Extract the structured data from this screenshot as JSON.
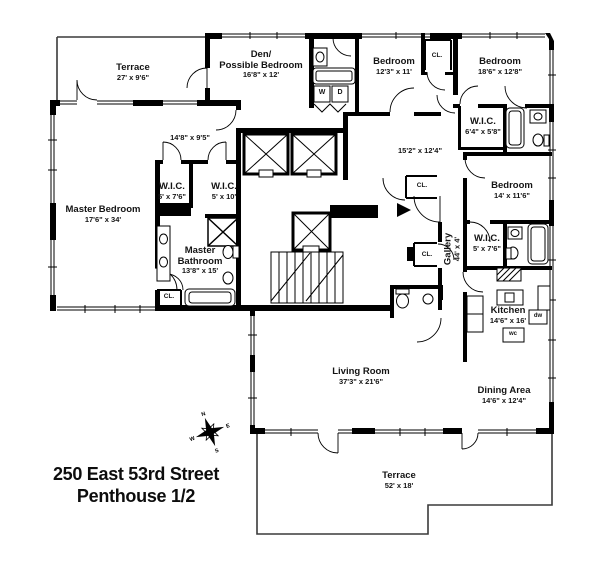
{
  "title": {
    "line1": "250 East 53rd Street",
    "line2": "Penthouse 1/2"
  },
  "rooms": {
    "terrace_top": {
      "name": "Terrace",
      "dims": "27' x 9'6\""
    },
    "den": {
      "name1": "Den/",
      "name2": "Possible Bedroom",
      "dims": "16'8\" x 12'"
    },
    "bedroom1": {
      "name": "Bedroom",
      "dims": "12'3\" x 11'"
    },
    "bedroom2": {
      "name": "Bedroom",
      "dims": "18'6\" x 12'8\""
    },
    "bedroom3": {
      "name": "Bedroom",
      "dims": "14' x 11'6\""
    },
    "master_bedroom": {
      "name": "Master Bedroom",
      "dims": "17'6\" x 34'"
    },
    "master_bathroom": {
      "name1": "Master",
      "name2": "Bathroom",
      "dims": "13'8\" x 15'"
    },
    "wic_master_left": {
      "name": "W.I.C.",
      "dims": "5' x 7'6\""
    },
    "wic_master_right": {
      "name": "W.I.C.",
      "dims": "5' x 10'"
    },
    "wic_bedroom2": {
      "name": "W.I.C.",
      "dims": "6'4\" x 5'8\""
    },
    "wic_bedroom3": {
      "name": "W.I.C.",
      "dims": "5' x 7'6\""
    },
    "hall": {
      "dims": "14'8\" x 9'5\""
    },
    "foyer": {
      "dims": "15'2\" x 12'4\""
    },
    "gallery": {
      "name": "Gallery",
      "dims": "44' x 4'"
    },
    "kitchen": {
      "name": "Kitchen",
      "dims": "14'6\" x 16'"
    },
    "living_room": {
      "name": "Living Room",
      "dims": "37'3\" x 21'6\""
    },
    "dining_area": {
      "name": "Dining Area",
      "dims": "14'6\" x 12'4\""
    },
    "terrace_bottom": {
      "name": "Terrace",
      "dims": "52' x 18'"
    }
  },
  "closets": {
    "cl_bedroom1": "CL.",
    "cl_foyer": "CL.",
    "cl_gallery": "CL.",
    "cl_master": "CL."
  },
  "appliances": {
    "washer": "W",
    "dryer": "D",
    "dishwasher": "dw",
    "wine_cooler": "wc"
  },
  "compass": {
    "n": "N",
    "e": "E",
    "s": "S",
    "w": "W"
  },
  "colors": {
    "wall": "#000000",
    "thin_line": "#3a3a3a",
    "text": "#141414",
    "background": "#ffffff"
  }
}
